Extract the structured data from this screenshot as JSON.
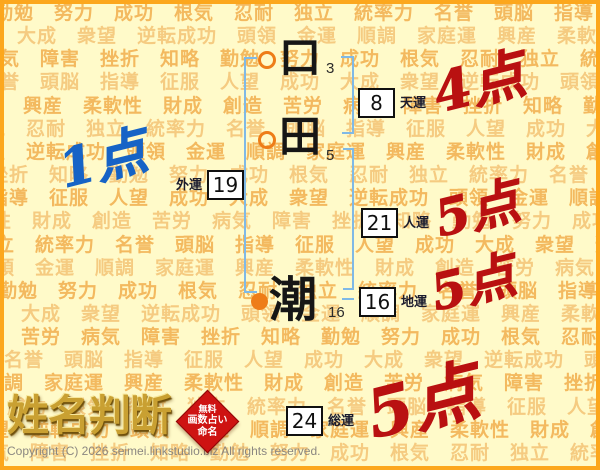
{
  "watermark": {
    "words": [
      "勤勉",
      "努力",
      "成功",
      "根気",
      "忍耐",
      "独立",
      "統率力",
      "名誉",
      "頭脳",
      "指導",
      "征服",
      "人望",
      "成功",
      "大成",
      "衆望",
      "逆転成功",
      "頭領",
      "金運",
      "順調",
      "家庭運",
      "興産",
      "柔軟性",
      "財成",
      "創造",
      "苦労",
      "病気",
      "障害",
      "挫折",
      "知略"
    ],
    "rows": 20,
    "row_colors": [
      "#f0a43c",
      "#f2bc6a"
    ]
  },
  "name": {
    "chars": [
      {
        "char": "口",
        "strokes": "3"
      },
      {
        "char": "田",
        "strokes": "5"
      },
      {
        "char": "潮",
        "strokes": "16"
      }
    ]
  },
  "fortunes": {
    "tenun": {
      "label": "天運",
      "value": "8",
      "score": "4点"
    },
    "gaiun": {
      "label": "外運",
      "value": "19",
      "score": "1点"
    },
    "jinun": {
      "label": "人運",
      "value": "21",
      "score": "5点"
    },
    "chiun": {
      "label": "地運",
      "value": "16",
      "score": "5点"
    },
    "soun": {
      "label": "総運",
      "value": "24",
      "score": "5点"
    }
  },
  "logo": {
    "title": "姓名判断",
    "seal_lines": [
      "無料",
      "画数占い",
      "命名"
    ]
  },
  "footer": {
    "copyright": "Copyright (C) 2026 seimei.linkstudio.biz All rights reserved."
  },
  "colors": {
    "bg": "#fffac9",
    "frame": "#fca71d",
    "bracket": "#7fb9e6",
    "score-red": "#b91111",
    "score-blue": "#1663c6",
    "marker-orange": "#ee7d18",
    "seal-red": "#ce1312",
    "logo-gold": "#c9a032",
    "label-ink": "#1c1c2e"
  }
}
